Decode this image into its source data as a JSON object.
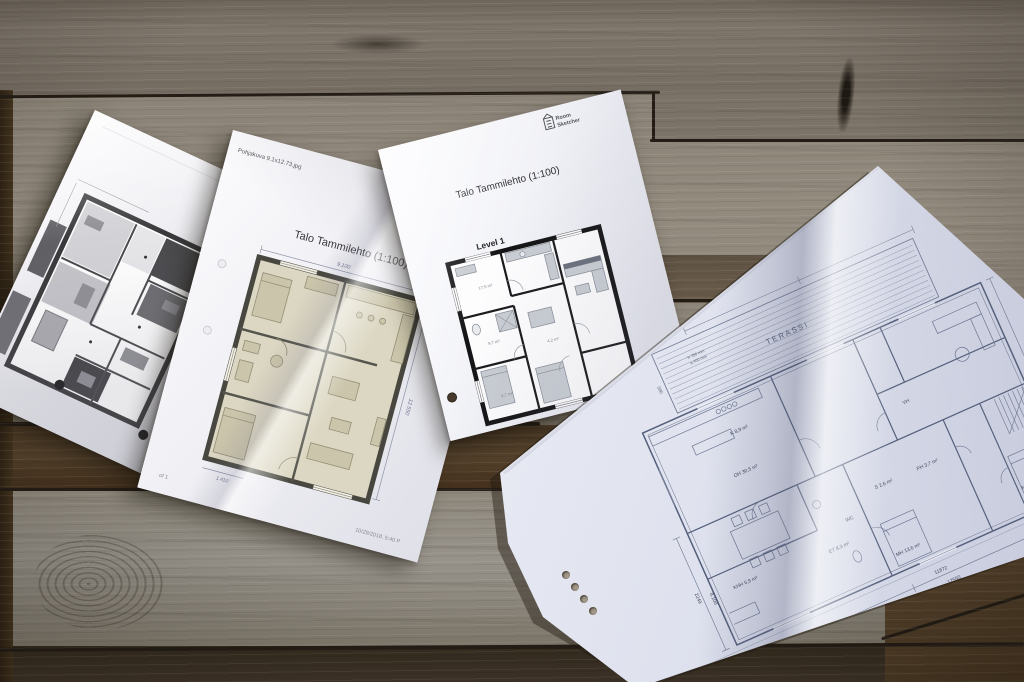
{
  "palette": {
    "wood_light": "#8e8679",
    "wood_mid": "#796f60",
    "wood_dark_band": "#47351f",
    "wood_bottom": "#382e20",
    "seam": "#231d15",
    "paper_white": "#f2f2f7",
    "beige_floor": "#dcd7c2",
    "wall_black": "#141416",
    "blueprint_line": "#6b7590"
  },
  "documents": {
    "doc2": {
      "filename": "Pohjakuva 9.1x12.73.jpg",
      "title": "Talo Tammilehto (1:100)",
      "level": "Level 1",
      "dim_width": "9.100",
      "dim_height": "12.550",
      "dim_bottom": "1.410",
      "printed": "10/29/2018, 5:40 P",
      "page": "of 1"
    },
    "doc3": {
      "logo_top": "Room",
      "logo_bottom": "Sketcher",
      "title": "Talo Tammilehto (1:100)",
      "level": "Level 1",
      "areas": [
        "17.5 m²",
        "9.7 m²",
        "9.7 m²",
        "4.2 m²"
      ]
    },
    "doc4": {
      "terrace": "TERASSI",
      "note1": "h 750 mm",
      "note2": "a 400 mm",
      "dims": [
        "580",
        "2249",
        "8.100",
        "11872",
        "12550"
      ],
      "rooms": [
        "OH 30,5 m²",
        "K 8,9 m²",
        "KHH 6,9 m²",
        "PH 3,7 m²",
        "S 2,6 m²",
        "MH 13,6 m²",
        "MH 10,2 m²",
        "ET 8,3 m²",
        "WC",
        "VH"
      ]
    }
  }
}
